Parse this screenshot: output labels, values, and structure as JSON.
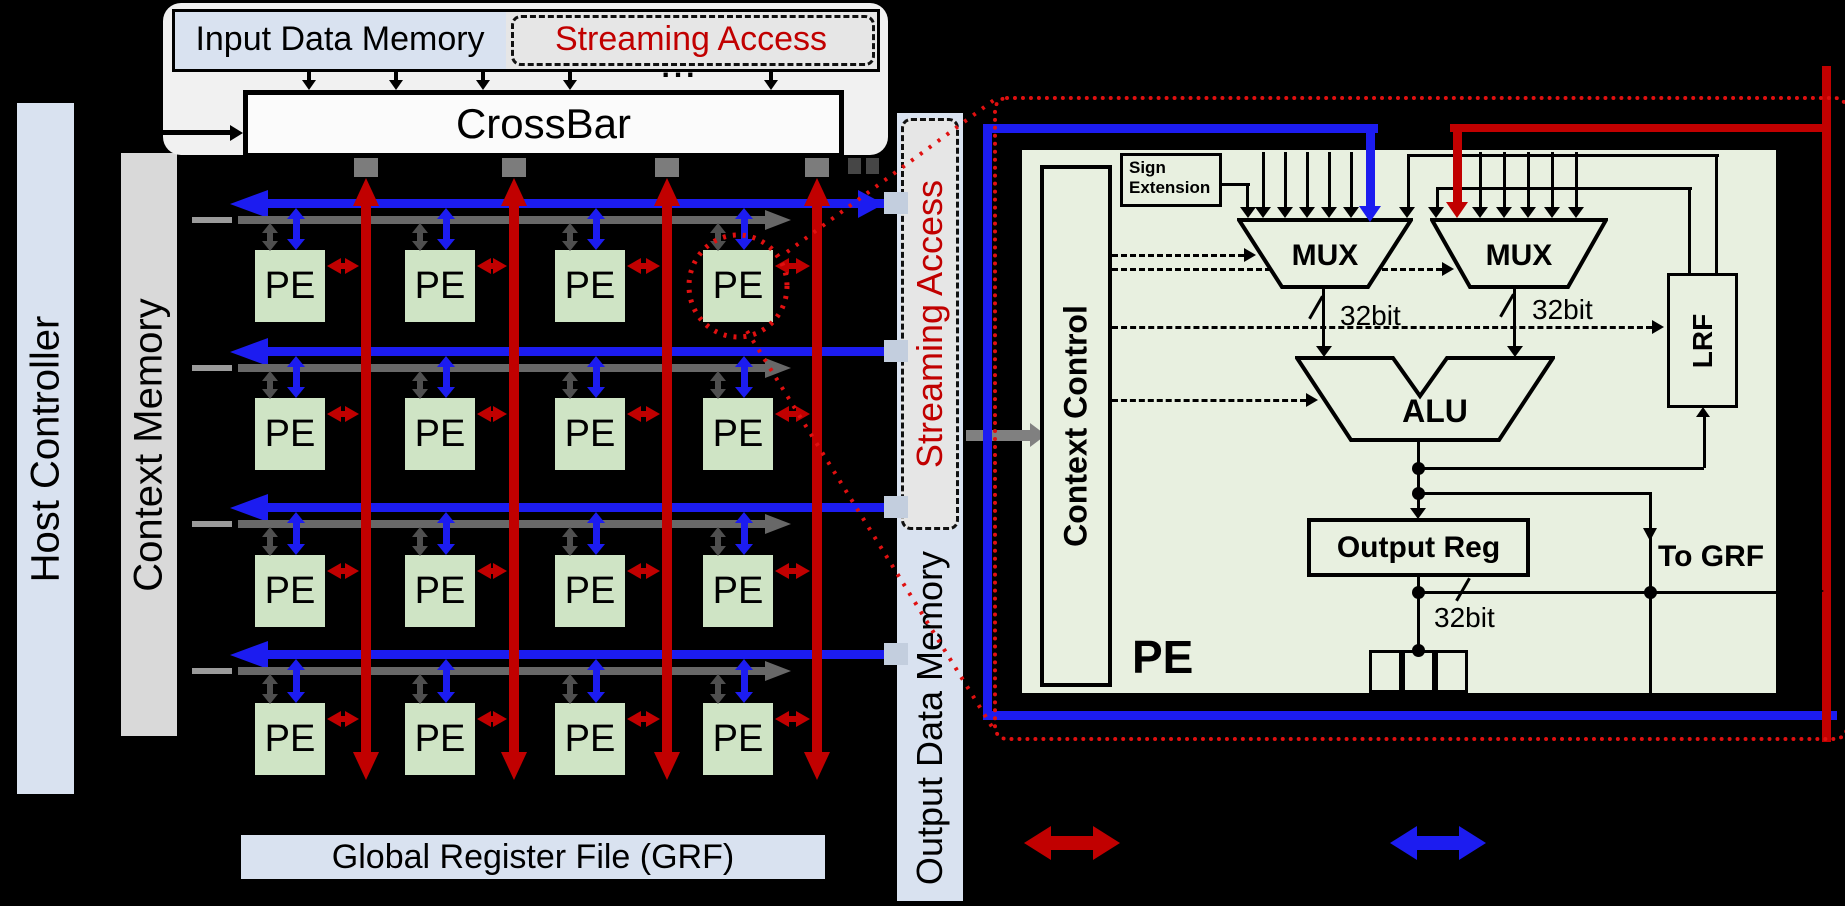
{
  "left_column": {
    "host_controller": "Host Controller",
    "context_memory": "Context Memory"
  },
  "top_section": {
    "input_data_memory": "Input Data Memory",
    "streaming_access": "Streaming Access",
    "crossbar": "CrossBar",
    "continuation_dots": "..."
  },
  "pe_array": {
    "pe_label": "PE"
  },
  "grf": {
    "label": "Global Register File (GRF)"
  },
  "output_memory": {
    "label": "Output Data Memory",
    "streaming_access": "Streaming Access"
  },
  "pe_detail": {
    "sign_extension": "Sign Extension",
    "context_control": "Context Control",
    "mux_left": "MUX",
    "mux_right": "MUX",
    "mux_left_width": "32bit",
    "mux_right_width": "32bit",
    "alu": "ALU",
    "output_reg": "Output Reg",
    "output_width": "32bit",
    "lrf": "LRF",
    "to_grf": "To GRF",
    "pe_label": "PE"
  },
  "colors": {
    "red_bus": "#c10000",
    "blue_bus": "#1c1cf0",
    "gray_bus": "#686868",
    "dashed_red": "#e01010",
    "pe_green": "#cfe4c5",
    "panel_green": "#e8f0e0",
    "memory_blue": "#d9e2f0",
    "memory_gray": "#e6e6e6"
  }
}
